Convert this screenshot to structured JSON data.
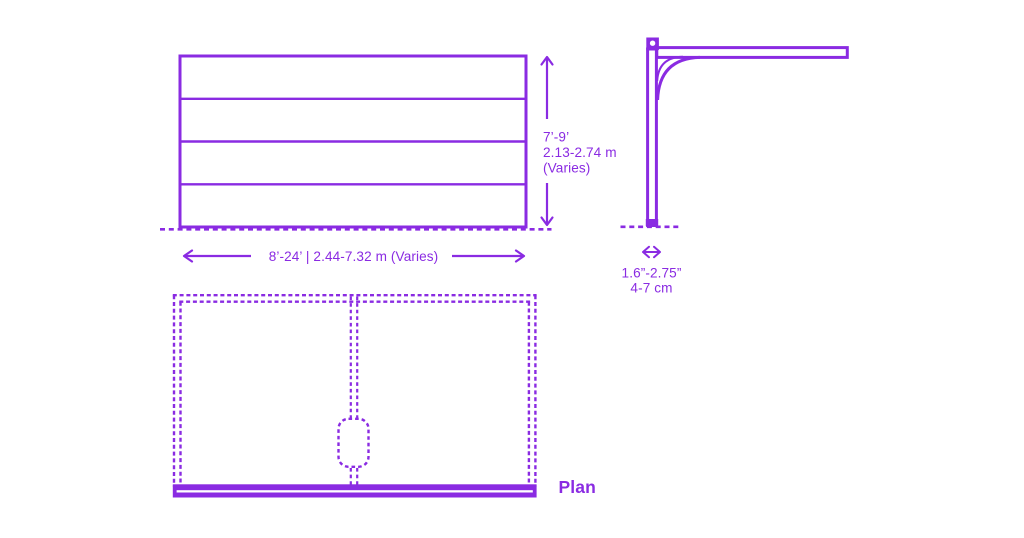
{
  "theme": {
    "accent": "#8A2BE2",
    "background": "#FFFFFF"
  },
  "views": {
    "elevation": {
      "name": "front elevation of sectional garage door",
      "panel_count": 4,
      "height_dimension": {
        "imperial": "7’-9’",
        "metric": "2.13-2.74 m",
        "note": "(Varies)"
      },
      "width_dimension": {
        "label": "8’-24’ | 2.44-7.32 m (Varies)"
      }
    },
    "side": {
      "name": "side section with overhead track",
      "thickness_dimension": {
        "imperial": "1.6”-2.75”",
        "metric": "4-7 cm"
      }
    },
    "plan": {
      "label": "Plan"
    }
  }
}
